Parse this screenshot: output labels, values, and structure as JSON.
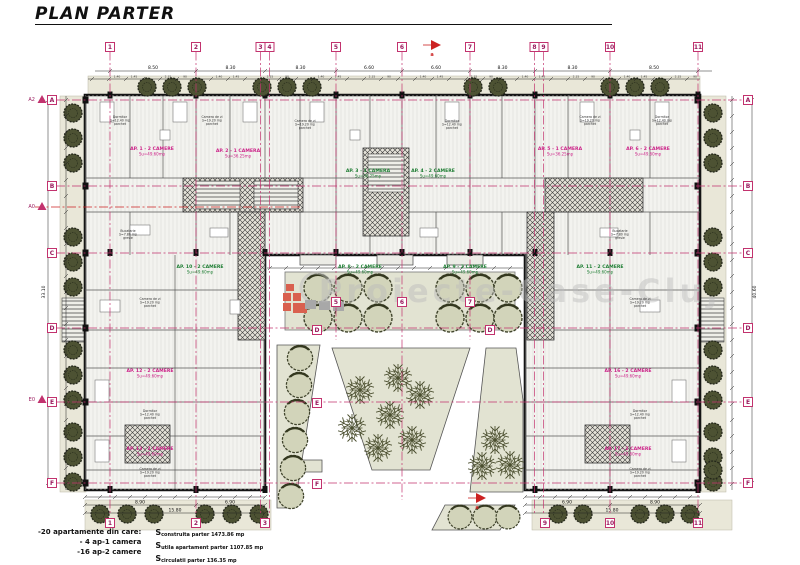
{
  "title": "PLAN PARTER",
  "watermark": "Proiecte-Case-Cluj",
  "legend": {
    "line1": "-20 apartamente din care:",
    "line2": "- 4 ap-1 camera",
    "line3": "-16 ap-2 camere",
    "s_lines": [
      {
        "prefix": "S",
        "rest": "construita parter 1473.86 mp"
      },
      {
        "prefix": "S",
        "rest": "utila apartament parter 1107.85 mp"
      },
      {
        "prefix": "S",
        "rest": "circulatii parter 136.35 mp"
      }
    ]
  },
  "colors": {
    "grid": "#c2326e",
    "bubble_text": "#9b1b5e",
    "section": "#cc2222",
    "label_magenta": "#cc2288",
    "label_green": "#1e7d33",
    "tree_dark": "#4d5233",
    "bush_fill": "#d2d4ba",
    "strip": "#e9e7d8",
    "garden": "#e2e3d2"
  },
  "grid": {
    "top": [
      {
        "label": "1",
        "x": 110,
        "y2": 515
      },
      {
        "label": "2",
        "x": 196,
        "y2": 515
      },
      {
        "label": "3",
        "x": 260.5,
        "y2": 515
      },
      {
        "label": "4",
        "x": 269.5,
        "y2": 515
      },
      {
        "label": "5",
        "x": 336,
        "y2": 340
      },
      {
        "label": "6",
        "x": 402,
        "y2": 500
      },
      {
        "label": "7",
        "x": 470,
        "y2": 340
      },
      {
        "label": "8",
        "x": 534.5,
        "y2": 515
      },
      {
        "label": "9",
        "x": 543.5,
        "y2": 515
      },
      {
        "label": "10",
        "x": 610,
        "y2": 515
      },
      {
        "label": "11",
        "x": 698,
        "y2": 515
      }
    ],
    "bottom": [
      {
        "label": "1",
        "x": 110
      },
      {
        "label": "2",
        "x": 196
      },
      {
        "label": "3",
        "x": 265
      },
      {
        "label": "9",
        "x": 545
      },
      {
        "label": "10",
        "x": 610
      },
      {
        "label": "11",
        "x": 698
      }
    ],
    "left": [
      {
        "label": "A",
        "y": 100
      },
      {
        "label": "B",
        "y": 186
      },
      {
        "label": "C",
        "y": 253
      },
      {
        "label": "D",
        "y": 328
      },
      {
        "label": "E",
        "y": 402
      },
      {
        "label": "F",
        "y": 483
      }
    ],
    "right": [
      {
        "label": "A",
        "y": 100
      },
      {
        "label": "B",
        "y": 186
      },
      {
        "label": "C",
        "y": 253
      },
      {
        "label": "D",
        "y": 328
      },
      {
        "label": "E",
        "y": 402
      },
      {
        "label": "F",
        "y": 483
      }
    ],
    "courtyard": [
      {
        "label": "5",
        "x": 336,
        "y": 302
      },
      {
        "label": "6",
        "x": 402,
        "y": 302
      },
      {
        "label": "7",
        "x": 470,
        "y": 302
      },
      {
        "label": "D",
        "x": 317,
        "y": 330
      },
      {
        "label": "D",
        "x": 490,
        "y": 330
      },
      {
        "label": "E",
        "x": 317,
        "y": 403
      },
      {
        "label": "F",
        "x": 317,
        "y": 484
      }
    ],
    "markers": [
      {
        "label": "A2",
        "x": 42,
        "y": 100
      },
      {
        "label": "A0",
        "x": 42,
        "y": 207
      },
      {
        "label": "E0",
        "x": 42,
        "y": 400
      }
    ],
    "section_arrows": [
      {
        "label": "a",
        "x": 433,
        "y": 45
      },
      {
        "label": "a",
        "x": 478,
        "y": 498
      }
    ]
  },
  "dimensions": {
    "top_segments": [
      "8.50",
      "8.30",
      "8.30",
      "6.60",
      "6.60",
      "8.30",
      "8.30",
      "8.50"
    ],
    "fine_cycle": [
      "1.40",
      "1.45",
      "80",
      "2.15",
      "90",
      "1.25"
    ],
    "bottom_left_mid": [
      "8.90",
      "6.90"
    ],
    "bottom_right_mid": [
      "6.90",
      "8.90"
    ],
    "bottom_left_overall": "15.80",
    "bottom_right_overall": "15.80",
    "left_overall": "33.10",
    "right_overall": "40.60"
  },
  "apartments": [
    {
      "t": "AP. 1 - 2 CAMERE",
      "s": "Su=49.60mp",
      "c": "m",
      "x": 152,
      "y": 150
    },
    {
      "t": "AP. 2 - 1 CAMERA",
      "s": "Su=36.25mp",
      "c": "m",
      "x": 238,
      "y": 152
    },
    {
      "t": "AP. 3 - 1 CAMERA",
      "s": "Su=36.25mp",
      "c": "g",
      "x": 368,
      "y": 172
    },
    {
      "t": "AP. 4 - 2 CAMERE",
      "s": "Su=49.60mp",
      "c": "g",
      "x": 433,
      "y": 172
    },
    {
      "t": "AP. 5 - 1 CAMERA",
      "s": "Su=36.25mp",
      "c": "m",
      "x": 560,
      "y": 150
    },
    {
      "t": "AP. 6 - 2 CAMERE",
      "s": "Su=49.60mp",
      "c": "m",
      "x": 648,
      "y": 150
    },
    {
      "t": "AP. 8 - 2 CAMERE",
      "s": "Su=49.60mp",
      "c": "g",
      "x": 360,
      "y": 268
    },
    {
      "t": "AP. 9 - 2 CAMERE",
      "s": "Su=49.60mp",
      "c": "g",
      "x": 465,
      "y": 268
    },
    {
      "t": "AP. 10 - 2 CAMERE",
      "s": "Su=49.60mp",
      "c": "g",
      "x": 200,
      "y": 268
    },
    {
      "t": "AP. 11 - 2 CAMERE",
      "s": "Su=49.60mp",
      "c": "g",
      "x": 600,
      "y": 268
    },
    {
      "t": "AP. 12 - 2 CAMERE",
      "s": "Su=49.60mp",
      "c": "m",
      "x": 150,
      "y": 372
    },
    {
      "t": "AP. 13 - 2 CAMERE",
      "s": "Su=49.60mp",
      "c": "m",
      "x": 150,
      "y": 450
    },
    {
      "t": "AP. 16 - 2 CAMERE",
      "s": "Su=49.60mp",
      "c": "m",
      "x": 628,
      "y": 372
    },
    {
      "t": "AP. 17 - 2 CAMERE",
      "s": "Su=49.60mp",
      "c": "m",
      "x": 628,
      "y": 450
    }
  ],
  "rooms": [
    {
      "x": 120,
      "y": 118,
      "l": "Dormitor|S=12.40 mp|parchet"
    },
    {
      "x": 212,
      "y": 118,
      "l": "Camera de zi|S=19.20 mp|parchet"
    },
    {
      "x": 305,
      "y": 122,
      "l": "Camera de zi|S=19.20 mp|parchet"
    },
    {
      "x": 452,
      "y": 122,
      "l": "Dormitor|S=12.40 mp|parchet"
    },
    {
      "x": 590,
      "y": 118,
      "l": "Camera de zi|S=19.20 mp|parchet"
    },
    {
      "x": 662,
      "y": 118,
      "l": "Dormitor|S=12.40 mp|parchet"
    },
    {
      "x": 128,
      "y": 232,
      "l": "Bucatarie|S=7.80 mp|gresie"
    },
    {
      "x": 620,
      "y": 232,
      "l": "Bucatarie|S=7.80 mp|gresie"
    },
    {
      "x": 150,
      "y": 300,
      "l": "Camera de zi|S=19.20 mp|parchet"
    },
    {
      "x": 150,
      "y": 412,
      "l": "Dormitor|S=12.40 mp|parchet"
    },
    {
      "x": 640,
      "y": 300,
      "l": "Camera de zi|S=19.20 mp|parchet"
    },
    {
      "x": 640,
      "y": 412,
      "l": "Dormitor|S=12.40 mp|parchet"
    },
    {
      "x": 150,
      "y": 470,
      "l": "Camera de zi|S=19.20 mp|parchet"
    },
    {
      "x": 640,
      "y": 470,
      "l": "Camera de zi|S=19.20 mp|parchet"
    }
  ],
  "landscape": {
    "trees_top": [
      147,
      172,
      197,
      262,
      287,
      312,
      473,
      498,
      610,
      635,
      660
    ],
    "trees_left_y": [
      113,
      138,
      163,
      237,
      262,
      287,
      350,
      375,
      400,
      432,
      457,
      482
    ],
    "trees_right_y": [
      113,
      138,
      163,
      237,
      262,
      287,
      350,
      375,
      400,
      432,
      457,
      482,
      470
    ],
    "trees_bottom_left_x": [
      100,
      127,
      154,
      205,
      232,
      259
    ],
    "trees_bottom_right_x": [
      558,
      583,
      640,
      665,
      690
    ],
    "garden_bushes_x": [
      318,
      348,
      378,
      450,
      480,
      508
    ],
    "garden_rows_y": [
      288,
      318
    ],
    "left_bed_bushes": [
      [
        300,
        358
      ],
      [
        299,
        385
      ],
      [
        297,
        412
      ],
      [
        295,
        440
      ],
      [
        293,
        468
      ],
      [
        291,
        496
      ]
    ],
    "bottom_bed_bushes": [
      [
        460,
        517
      ],
      [
        485,
        517
      ],
      [
        508,
        517
      ]
    ],
    "ftrees_center": [
      [
        360,
        390
      ],
      [
        398,
        378
      ],
      [
        352,
        428
      ],
      [
        390,
        415
      ],
      [
        420,
        395
      ],
      [
        378,
        448
      ],
      [
        412,
        440
      ]
    ],
    "ftrees_right": [
      [
        495,
        440
      ],
      [
        510,
        465
      ],
      [
        482,
        466
      ]
    ]
  }
}
